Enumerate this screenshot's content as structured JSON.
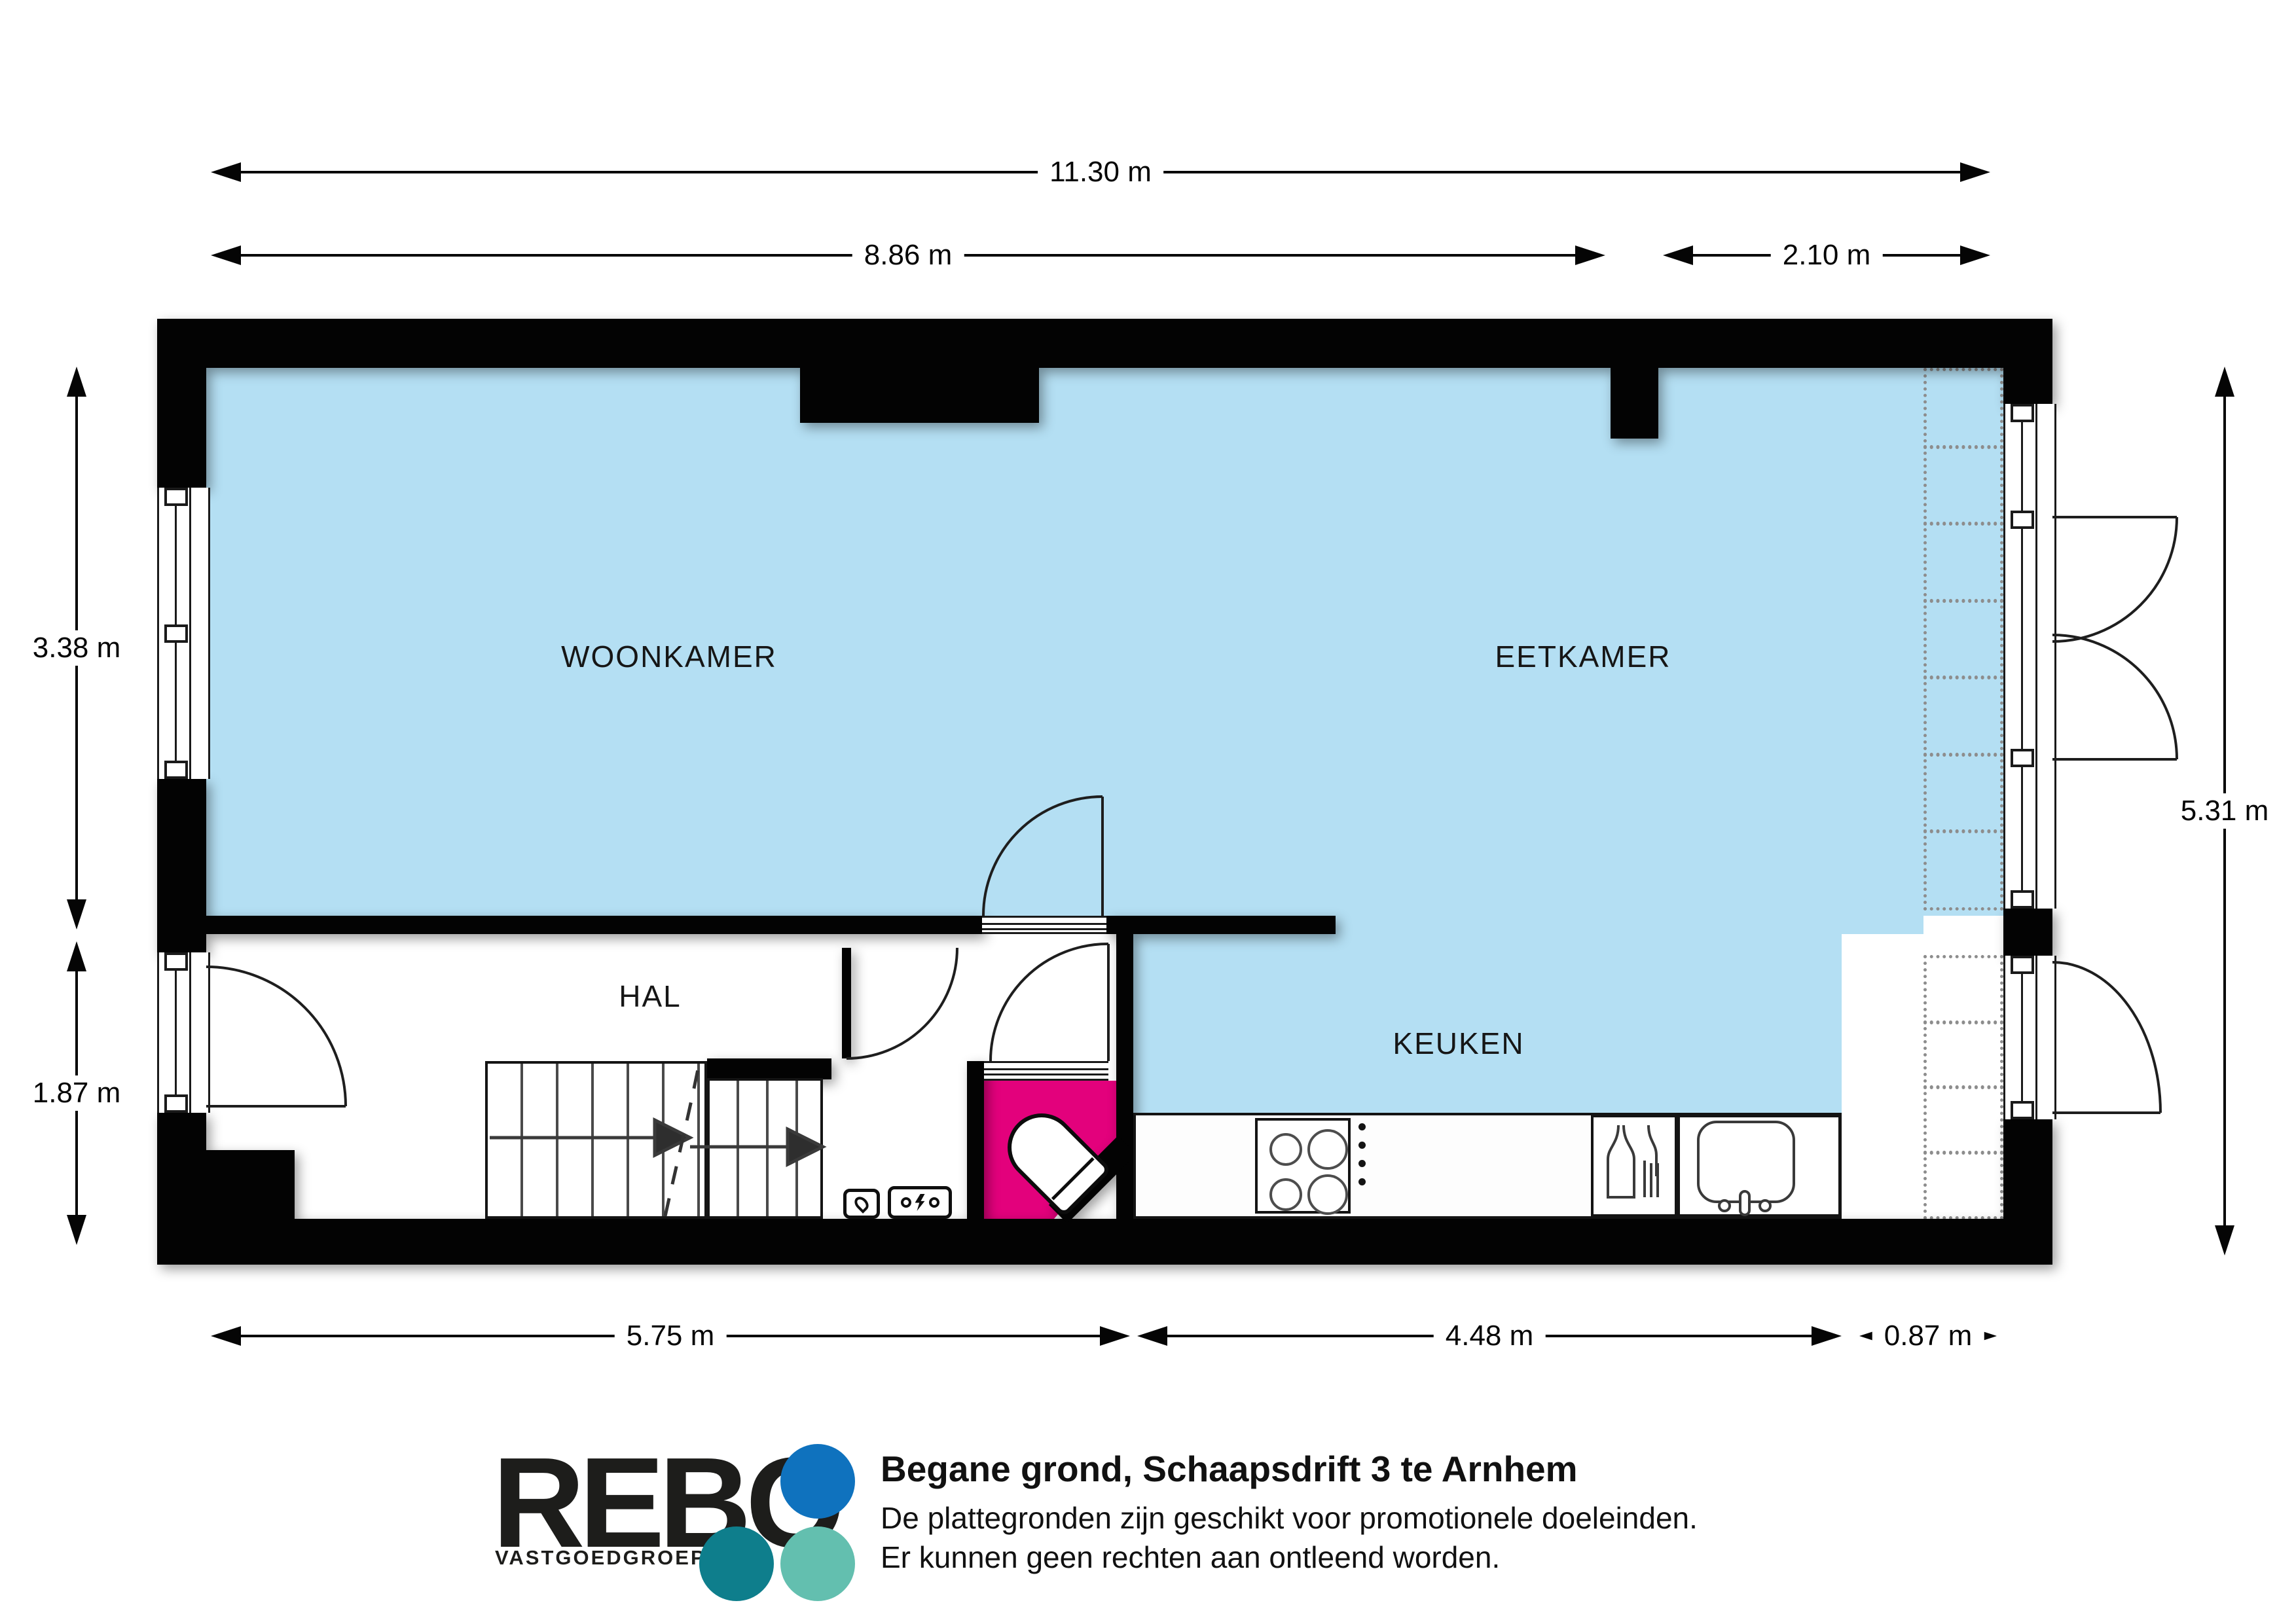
{
  "plan": {
    "floor_name": "Begane grond",
    "rooms": {
      "woonkamer": "WOONKAMER",
      "eetkamer": "EETKAMER",
      "hal": "HAL",
      "keuken": "KEUKEN"
    }
  },
  "dimensions": {
    "top_total": "11.30 m",
    "top_left": "8.86 m",
    "top_right": "2.10 m",
    "left_upper": "3.38 m",
    "left_lower": "1.87 m",
    "right_total": "5.31 m",
    "bottom_left": "5.75 m",
    "bottom_middle": "4.48 m",
    "bottom_right": "0.87 m"
  },
  "footer": {
    "brand": "REBO",
    "brand_sub": "VASTGOEDGROEP",
    "title": "Begane grond, Schaapsdrift 3 te Arnhem",
    "disclaimer_line1": "De plattegronden zijn geschikt voor promotionele doeleinden.",
    "disclaimer_line2": "Er kunnen geen rechten aan ontleend worden."
  },
  "palette": {
    "floor_blue": "#b4dff3",
    "toilet_pink": "#e3017c",
    "wall_black": "#030303",
    "logo_blue": "#0f72be",
    "logo_teal": "#0e7e8c",
    "logo_seafoam": "#63bfaf"
  }
}
